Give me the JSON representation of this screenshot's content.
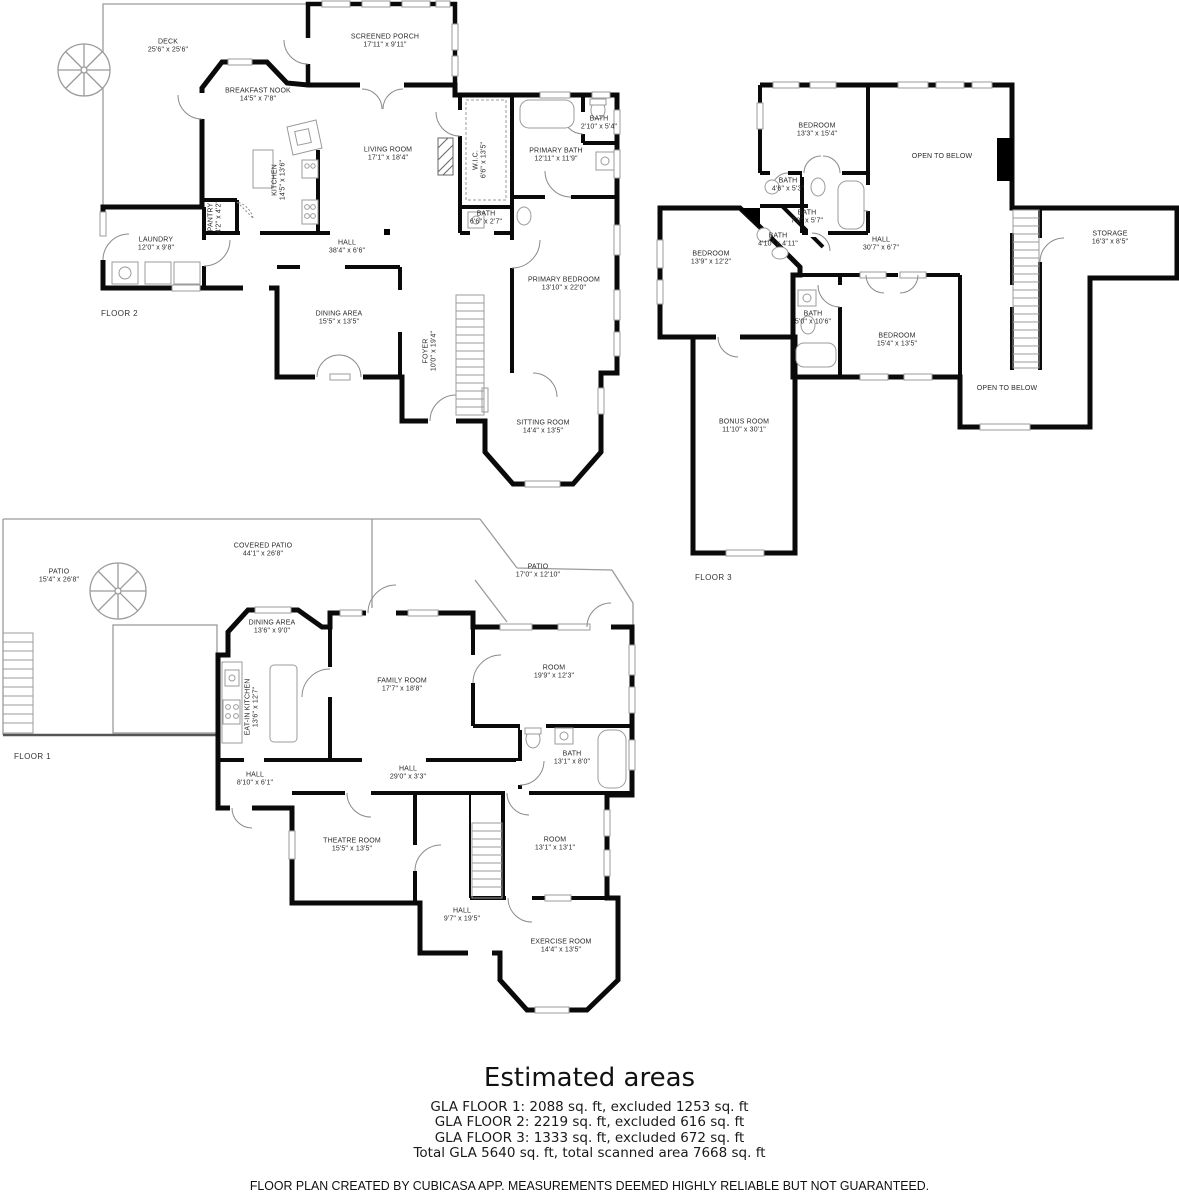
{
  "floor2": {
    "tag": "FLOOR 2",
    "deck": {
      "name": "DECK",
      "dims": "25'6\" x 25'6\""
    },
    "screened_porch": {
      "name": "SCREENED PORCH",
      "dims": "17'11\" x 9'11\""
    },
    "breakfast_nook": {
      "name": "BREAKFAST NOOK",
      "dims": "14'5\" x 7'8\""
    },
    "living_room": {
      "name": "LIVING ROOM",
      "dims": "17'1\" x 18'4\""
    },
    "kitchen": {
      "name": "KITCHEN",
      "dims": "14'5\" x 13'6\""
    },
    "wic": {
      "name": "W.I.C.",
      "dims": "6'6\" x 13'5\""
    },
    "bath_top": {
      "name": "BATH",
      "dims": "2'10\" x 5'4\""
    },
    "primary_bath": {
      "name": "PRIMARY BATH",
      "dims": "12'11\" x 11'9\""
    },
    "pantry": {
      "name": "PANTRY",
      "dims": "4'2\" x 4'2\""
    },
    "laundry": {
      "name": "LAUNDRY",
      "dims": "12'0\" x 9'8\""
    },
    "hall": {
      "name": "HALL",
      "dims": "38'4\" x 6'6\""
    },
    "bath_mid": {
      "name": "BATH",
      "dims": "6'6\" x 2'7\""
    },
    "primary_bedroom": {
      "name": "PRIMARY BEDROOM",
      "dims": "13'10\" x 22'0\""
    },
    "dining_area": {
      "name": "DINING AREA",
      "dims": "15'5\" x 13'5\""
    },
    "foyer": {
      "name": "FOYER",
      "dims": "10'0\" x 19'4\""
    },
    "sitting_room": {
      "name": "SITTING ROOM",
      "dims": "14'4\" x 13'5\""
    }
  },
  "floor3": {
    "tag": "FLOOR 3",
    "bedroom_top": {
      "name": "BEDROOM",
      "dims": "13'3\" x 15'4\""
    },
    "open_to_below_top": {
      "name": "OPEN TO BELOW"
    },
    "bath_small_top": {
      "name": "BATH",
      "dims": "4'6\" x 5'3\""
    },
    "bath_mid": {
      "name": "BATH",
      "dims": "7'0\" x 5'7\""
    },
    "bath_small_left": {
      "name": "BATH",
      "dims": "4'10\" x 4'11\""
    },
    "bedroom_left": {
      "name": "BEDROOM",
      "dims": "13'9\" x 12'2\""
    },
    "hall": {
      "name": "HALL",
      "dims": "30'7\" x 6'7\""
    },
    "storage": {
      "name": "STORAGE",
      "dims": "16'3\" x 8'5\""
    },
    "bath_lower": {
      "name": "BATH",
      "dims": "5'0\" x 10'6\""
    },
    "bedroom_lower": {
      "name": "BEDROOM",
      "dims": "15'4\" x 13'5\""
    },
    "open_to_below_lower": {
      "name": "OPEN TO BELOW"
    },
    "bonus_room": {
      "name": "BONUS ROOM",
      "dims": "11'10\" x 30'1\""
    }
  },
  "floor1": {
    "tag": "FLOOR 1",
    "patio_left": {
      "name": "PATIO",
      "dims": "15'4\" x 26'8\""
    },
    "covered_patio": {
      "name": "COVERED PATIO",
      "dims": "44'1\" x 26'8\""
    },
    "patio_right": {
      "name": "PATIO",
      "dims": "17'0\" x 12'10\""
    },
    "dining_area": {
      "name": "DINING AREA",
      "dims": "13'6\" x 9'0\""
    },
    "family_room": {
      "name": "FAMILY ROOM",
      "dims": "17'7\" x 18'8\""
    },
    "eat_in_kitchen": {
      "name": "EAT-IN KITCHEN",
      "dims": "13'6\" x 12'7\""
    },
    "room_right": {
      "name": "ROOM",
      "dims": "19'9\" x 12'3\""
    },
    "bath": {
      "name": "BATH",
      "dims": "13'1\" x 8'0\""
    },
    "hall_small": {
      "name": "HALL",
      "dims": "8'10\" x 6'1\""
    },
    "hall_long": {
      "name": "HALL",
      "dims": "29'0\" x 3'3\""
    },
    "theatre_room": {
      "name": "THEATRE ROOM",
      "dims": "15'5\" x 13'5\""
    },
    "room_lower": {
      "name": "ROOM",
      "dims": "13'1\" x 13'1\""
    },
    "hall_lower": {
      "name": "HALL",
      "dims": "9'7\" x 19'5\""
    },
    "exercise_room": {
      "name": "EXERCISE ROOM",
      "dims": "14'4\" x 13'5\""
    }
  },
  "summary": {
    "title": "Estimated areas",
    "lines": [
      "GLA FLOOR 1: 2088 sq. ft, excluded 1253 sq. ft",
      "GLA FLOOR 2: 2219 sq. ft, excluded 616 sq. ft",
      "GLA FLOOR 3: 1333 sq. ft, excluded 672 sq. ft",
      "Total GLA 5640 sq. ft, total scanned area 7668 sq. ft"
    ]
  },
  "footer": "FLOOR PLAN CREATED BY CUBICASA APP. MEASUREMENTS DEEMED HIGHLY RELIABLE BUT NOT GUARANTEED."
}
